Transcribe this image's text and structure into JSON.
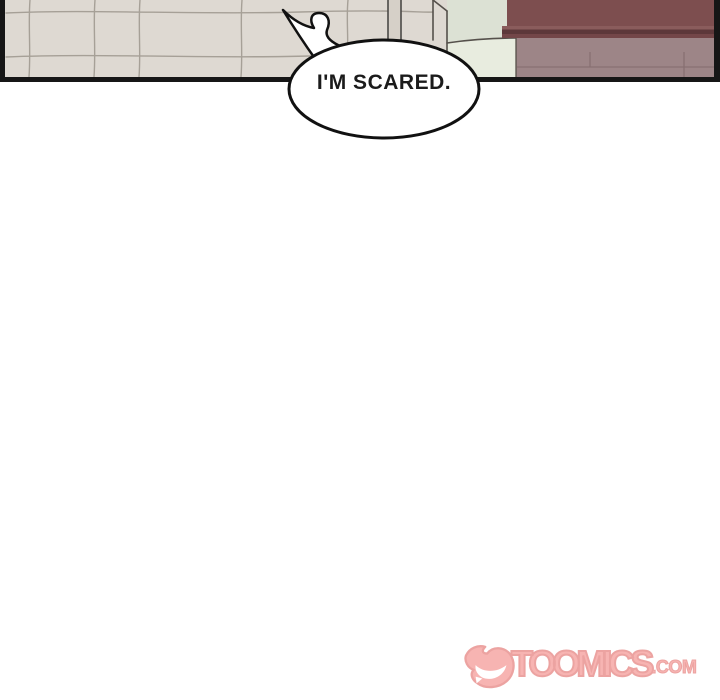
{
  "page": {
    "width": 720,
    "height": 700,
    "background": "#ffffff"
  },
  "comic_panel": {
    "description": "top strip of a webtoon panel: tiled beige wall, pale green appliance, dark maroon cabinet",
    "colors": {
      "wall": "#ded9d2",
      "tile_line": "#a09a91",
      "pole": "#d6d0c8",
      "appliance": "#dce1d4",
      "appliance_light": "#e8ecdf",
      "cabinet_top": "#7d4e4f",
      "cabinet_lip": "#5d383a",
      "cabinet_front": "#9d8587",
      "border": "#161616"
    },
    "speech_bubble": {
      "text": "I'M SCARED.",
      "fill": "#ffffff",
      "stroke": "#111111"
    }
  },
  "watermark": {
    "brand": "TOOMICS",
    "suffix": ".COM",
    "fill_color": "#f7b0ae",
    "outline_color": "#eb9f9d"
  }
}
